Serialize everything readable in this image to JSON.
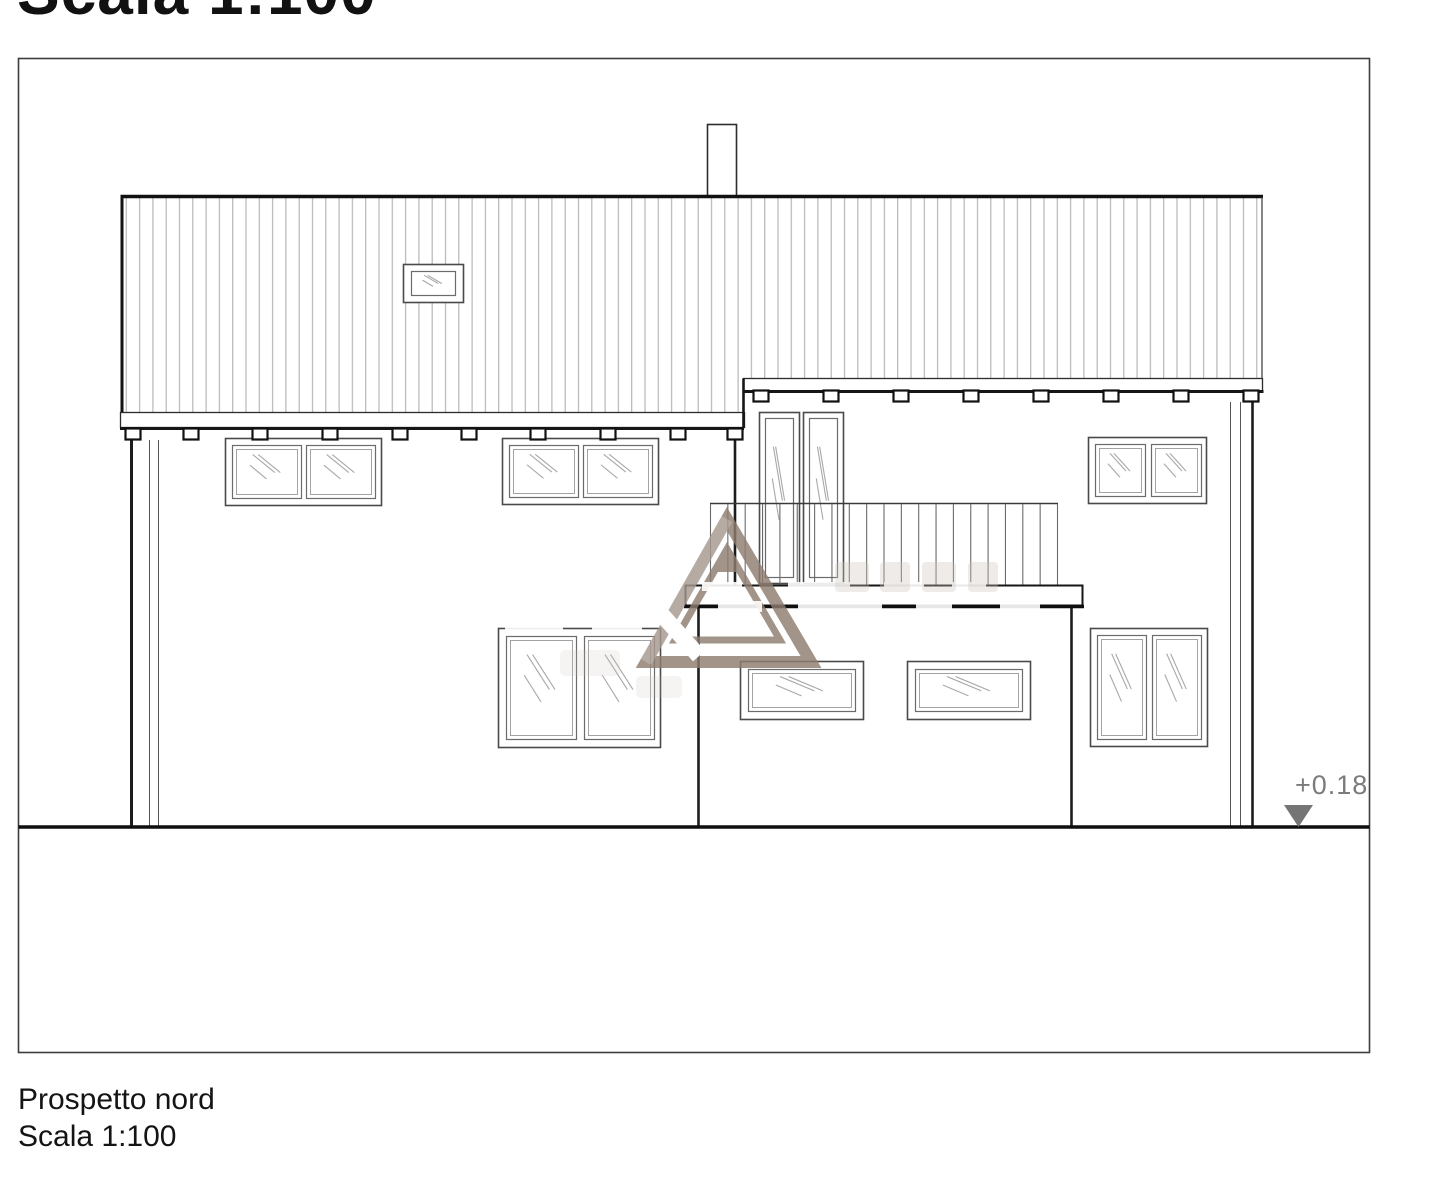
{
  "header": {
    "clipped_title": "Scala 1:100"
  },
  "caption": {
    "title": "Prospetto nord",
    "scale": "Scala 1:100"
  },
  "elevation_marker": {
    "label": "+0.18",
    "color": "#7b7b7b"
  },
  "watermark": {
    "logo": "triangle-a-logo",
    "color": "#8e7d70"
  },
  "colors": {
    "background": "#ffffff",
    "frame": "#3d3d3d",
    "line": "#1c1c1c",
    "roof_hatch": "#b3b3b3",
    "glazing": "#a8a8a8"
  }
}
